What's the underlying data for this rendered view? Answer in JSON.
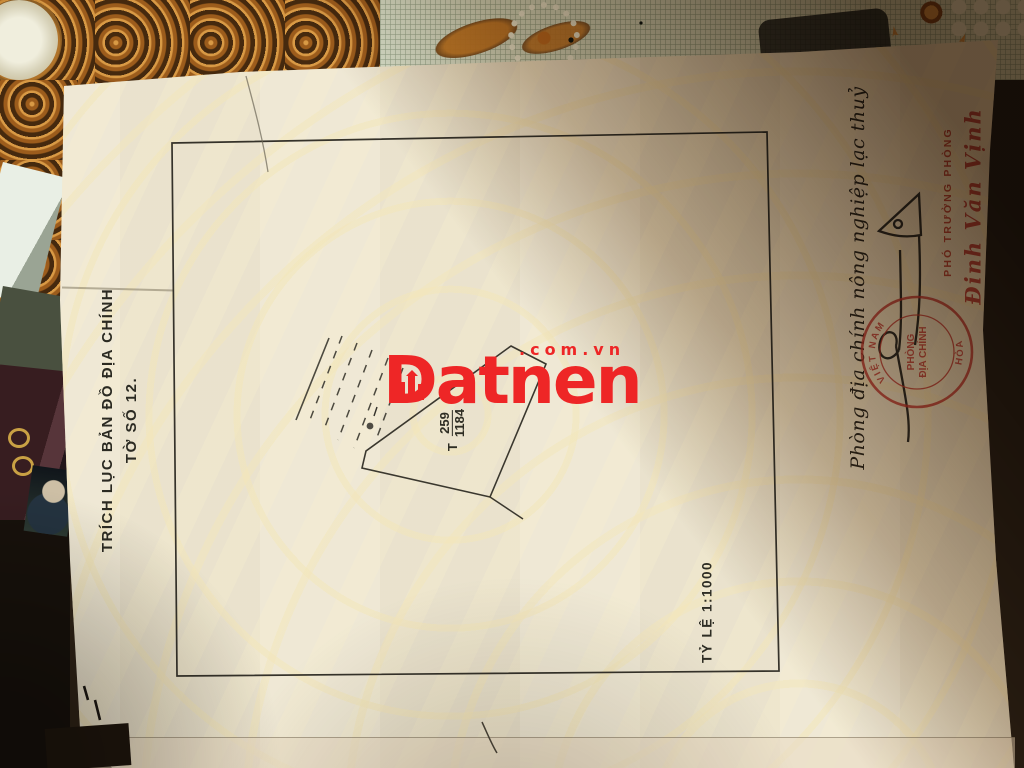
{
  "watermark": {
    "brand": "Datnen",
    "domain": ".com.vn",
    "color": "#ee2626"
  },
  "paper": {
    "side_title_line1": "TRÍCH LỤC BẢN ĐỒ ĐỊA CHÍNH",
    "side_title_line2": "TỜ SỐ 12.",
    "scale_label": "TỶ LỆ 1:1000",
    "parcel": {
      "prefix": "T",
      "number": "259",
      "area": "1184"
    }
  },
  "annotations": {
    "office_line": "Phòng địa chính nông nghiệp lạc thuỷ",
    "position_title": "PHÓ TRƯỞNG PHÒNG",
    "signer_name": "Đinh Văn Vịnh",
    "stamp": {
      "ring_top": "VIỆT NAM",
      "ring_bottom": "HÒA",
      "center_line1": "PHÒNG",
      "center_line2": "ĐỊA CHÍNH",
      "color": "#c23b2e"
    }
  },
  "colors": {
    "paper": "#ece5d1",
    "ink": "#2e2d24",
    "stamp_red": "#c23b2e",
    "watermark_red": "#ee2626"
  }
}
